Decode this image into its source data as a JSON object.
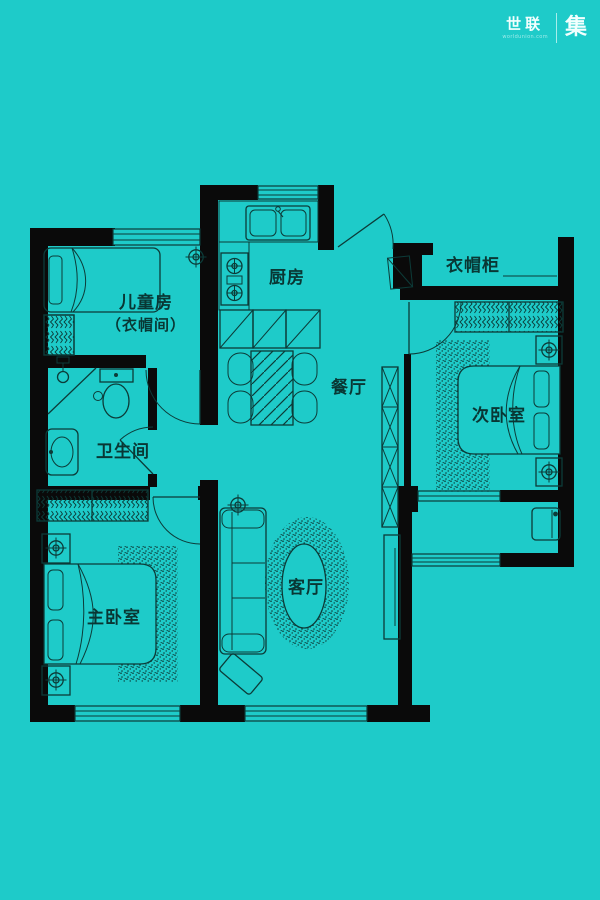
{
  "logo": {
    "brand": "世联",
    "tagline": "worldunion.com",
    "suffix": "集"
  },
  "rooms": {
    "children": {
      "label": "儿童房",
      "sublabel": "（衣帽间）"
    },
    "kitchen": {
      "label": "厨房"
    },
    "cloak_cabinet": {
      "label": "衣帽柜"
    },
    "dining": {
      "label": "餐厅"
    },
    "second_bedroom": {
      "label": "次卧室"
    },
    "bathroom": {
      "label": "卫生间"
    },
    "master_bedroom": {
      "label": "主卧室"
    },
    "living": {
      "label": "客厅"
    }
  },
  "colors": {
    "background": "#1ecbc9",
    "wall": "#0a0a0a",
    "line": "#0c3b38",
    "label": "#093734",
    "logo_text": "#f2fffe"
  }
}
